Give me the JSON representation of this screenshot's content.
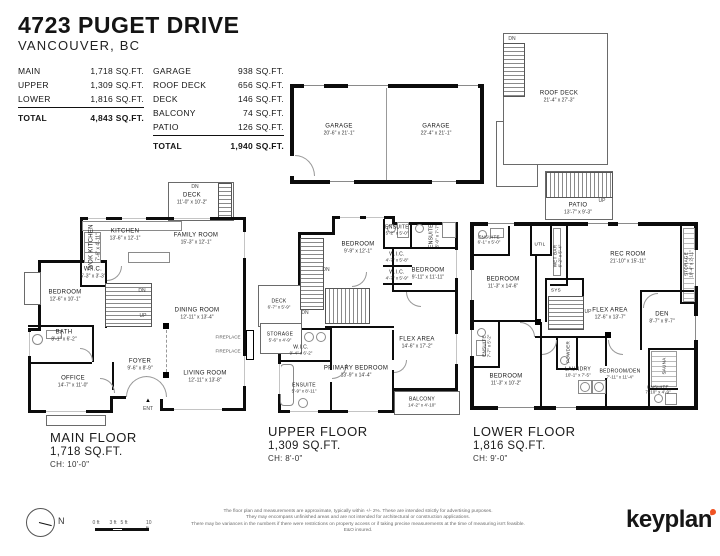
{
  "header": {
    "title": "4723 PUGET DRIVE",
    "subtitle": "VANCOUVER, BC"
  },
  "areas_left": {
    "rows": [
      {
        "label": "MAIN",
        "value": "1,718 SQ.FT."
      },
      {
        "label": "UPPER",
        "value": "1,309 SQ.FT."
      },
      {
        "label": "LOWER",
        "value": "1,816 SQ.FT."
      }
    ],
    "total_label": "TOTAL",
    "total_value": "4,843 SQ.FT."
  },
  "areas_right": {
    "rows": [
      {
        "label": "GARAGE",
        "value": "938 SQ.FT."
      },
      {
        "label": "ROOF DECK",
        "value": "656 SQ.FT."
      },
      {
        "label": "DECK",
        "value": "146 SQ.FT."
      },
      {
        "label": "BALCONY",
        "value": "74 SQ.FT."
      },
      {
        "label": "PATIO",
        "value": "126 SQ.FT."
      }
    ],
    "total_label": "TOTAL",
    "total_value": "1,940 SQ.FT."
  },
  "garage": {
    "left": {
      "name": "GARAGE",
      "dims": "20'-6\" x 21'-1\""
    },
    "right": {
      "name": "GARAGE",
      "dims": "22'-4\" x 21'-1\""
    }
  },
  "roof": {
    "dn": "DN",
    "deck": {
      "name": "ROOF DECK",
      "dims": "21'-4\" x 27'-3\""
    },
    "patio": {
      "name": "PATIO",
      "dims": "13'-7\" x 9'-3\"",
      "up": "UP"
    }
  },
  "main": {
    "label": {
      "name": "MAIN FLOOR",
      "area": "1,718 SQ.FT.",
      "ch": "CH: 10'-0\""
    },
    "rooms": {
      "deck": {
        "name": "DECK",
        "dims": "11'-0\" x 10'-2\""
      },
      "kitchen": {
        "name": "KITCHEN",
        "dims": "13'-6\" x 12'-1\""
      },
      "wok": {
        "name": "WOK KITCHEN",
        "dims": "7'-6\" x 4'-11\""
      },
      "family": {
        "name": "FAMILY ROOM",
        "dims": "15'-3\" x 12'-1\""
      },
      "wic": {
        "name": "W.I.C.",
        "dims": "5'-3\" x 3'-3\""
      },
      "bedroom": {
        "name": "BEDROOM",
        "dims": "12'-6\" x 10'-1\""
      },
      "dining": {
        "name": "DINING ROOM",
        "dims": "12'-11\" x 13'-4\""
      },
      "bath": {
        "name": "BATH",
        "dims": "8'-1\" x 6'-2\""
      },
      "office": {
        "name": "OFFICE",
        "dims": "14'-7\" x 11'-0\""
      },
      "foyer": {
        "name": "FOYER",
        "dims": "9'-6\" x 8'-9\""
      },
      "living": {
        "name": "LIVING ROOM",
        "dims": "12'-11\" x 13'-8\""
      }
    },
    "notes": {
      "deck_dn": "DN",
      "dn": "DN",
      "up": "UP",
      "ent": "ENT",
      "fireplace1": "FIREPLACE",
      "fireplace2": "FIREPLACE"
    }
  },
  "upper": {
    "label": {
      "name": "UPPER FLOOR",
      "area": "1,309 SQ.FT.",
      "ch": "CH: 8'-0\""
    },
    "rooms": {
      "bedroom1": {
        "name": "BEDROOM",
        "dims": "9'-9\" x 12'-1\""
      },
      "ensuite1": {
        "name": "ENSUITE",
        "dims": "5'-2\" x 5'-0\""
      },
      "ensuite2": {
        "name": "ENSUITE",
        "dims": "5'-0\" x 7'-7\""
      },
      "wic1": {
        "name": "W.I.C.",
        "dims": "4'-7\" x 5'-8\""
      },
      "wic2": {
        "name": "W.I.C.",
        "dims": "4'-7\" x 5'-9\""
      },
      "bedroom2": {
        "name": "BEDROOM",
        "dims": "9'-11\" x 11'-11\""
      },
      "deck": {
        "name": "DECK",
        "dims": "6'-7\" x 5'-9\""
      },
      "storage": {
        "name": "STORAGE",
        "dims": "5'-6\" x 4'-9\""
      },
      "wic3": {
        "name": "W.I.C.",
        "dims": "9'-4\" x 6'-2\""
      },
      "primary": {
        "name": "PRIMARY BEDROOM",
        "dims": "13'-9\" x 14'-4\""
      },
      "ensuite3": {
        "name": "ENSUITE",
        "dims": "5'-9\" x 8'-11\""
      },
      "flex": {
        "name": "FLEX AREA",
        "dims": "14'-6\" x 17'-2\""
      },
      "balcony": {
        "name": "BALCONY",
        "dims": "14'-2\" x 4'-10\""
      }
    },
    "notes": {
      "dn1": "DN",
      "dn2": "DN"
    }
  },
  "lower": {
    "label": {
      "name": "LOWER FLOOR",
      "area": "1,816 SQ.FT.",
      "ch": "CH: 9'-0\""
    },
    "rooms": {
      "ensuite1": {
        "name": "ENSUITE",
        "dims": "6'-1\" x 5'-0\""
      },
      "util": {
        "name": "UTIL"
      },
      "wetbar": {
        "name": "WET BAR",
        "dims": "6'-2\" x 5'-4\""
      },
      "rec": {
        "name": "REC ROOM",
        "dims": "21'-10\" x 15'-11\""
      },
      "bedroom1": {
        "name": "BEDROOM",
        "dims": "11'-3\" x 14'-6\""
      },
      "sys": {
        "name": "SYS"
      },
      "flex": {
        "name": "FLEX AREA",
        "dims": "12'-6\" x 13'-7\""
      },
      "den": {
        "name": "DEN",
        "dims": "8'-7\" x 9'-7\""
      },
      "storage": {
        "name": "STORAGE",
        "dims": "10'-4\" x 2'-11\""
      },
      "ensuite2": {
        "name": "ENSUITE",
        "dims": "7'-7\" x 5'-2\""
      },
      "bedroom2": {
        "name": "BEDROOM",
        "dims": "11'-3\" x 10'-2\""
      },
      "laundry": {
        "name": "LAUNDRY",
        "dims": "10'-1\" x 7'-5\""
      },
      "powder": {
        "name": "POWDER",
        "dims": "5'-0\" x 5'-2\""
      },
      "bedden": {
        "name": "BEDROOM/DEN",
        "dims": "7'-11\" x 11'-4\""
      },
      "sauna": {
        "name": "SAUNA",
        "dims": "8'-6\" x 5'-4\""
      },
      "ensuite3": {
        "name": "ENSUITE",
        "dims": "7'-10\" x 4'-9\""
      }
    },
    "notes": {
      "up": "UP"
    }
  },
  "footer": {
    "north": "N",
    "scale": [
      "0 ft",
      "3 ft",
      "5 ft",
      "10 ft"
    ],
    "disclaimer": [
      "The floor plan and measurements are approximate, typically within +/- 2%. These are intended strictly for advertising purposes.",
      "They may encompass unfinished areas and are not intended for architectural or construction applications.",
      "There may be variances in the numbers if there were restrictions on property access or if taking precise measurements at the time of measuring isn't feasible. E&O insured."
    ],
    "brand": "keyplan"
  },
  "colors": {
    "accent": "#f05323",
    "wall": "#0c0c0c"
  }
}
